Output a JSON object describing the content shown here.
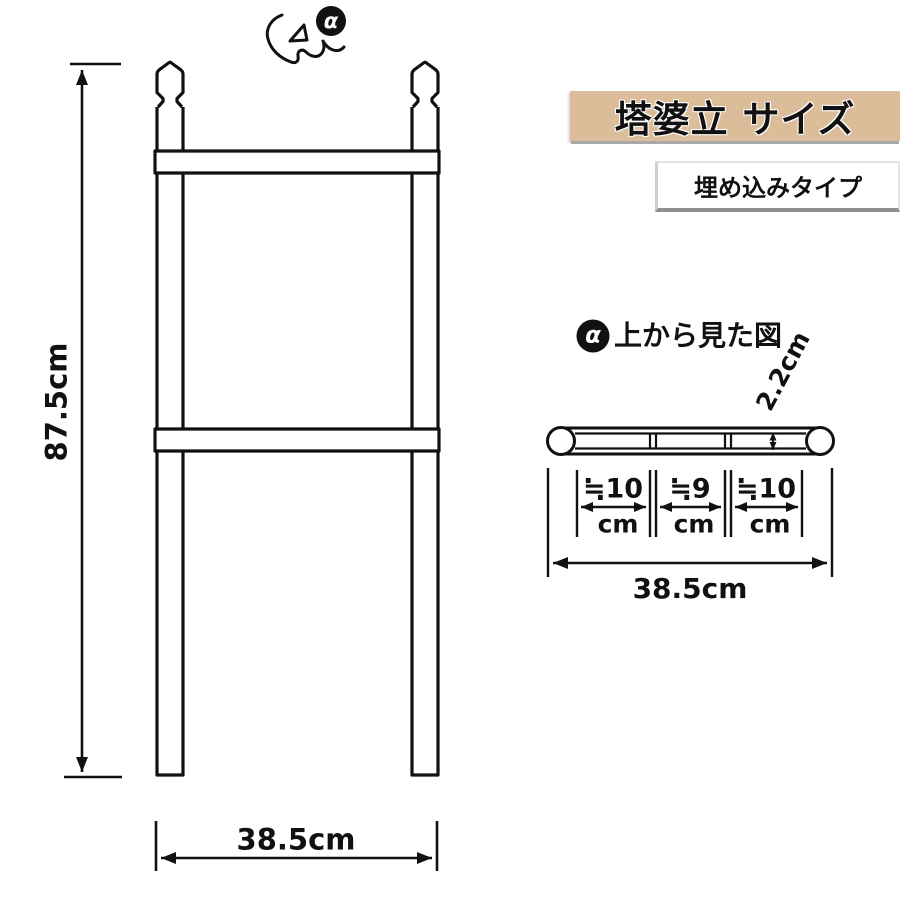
{
  "colors": {
    "line": "#111111",
    "header_bg": "#dcbd9a",
    "subtitle_bg": "#ffffff",
    "badge_bg": "#111111"
  },
  "alpha_marker": "α",
  "header": {
    "title": "塔婆立 サイズ",
    "subtitle": "埋め込みタイプ"
  },
  "front_view": {
    "height_label": "87.5cm",
    "width_label": "38.5cm"
  },
  "top_view": {
    "heading": "上から見た図",
    "thickness_label": "2.2cm",
    "width_label": "38.5cm",
    "segments": [
      {
        "value": "≒10",
        "unit": "cm"
      },
      {
        "value": "≒9",
        "unit": "cm"
      },
      {
        "value": "≒10",
        "unit": "cm"
      }
    ]
  }
}
